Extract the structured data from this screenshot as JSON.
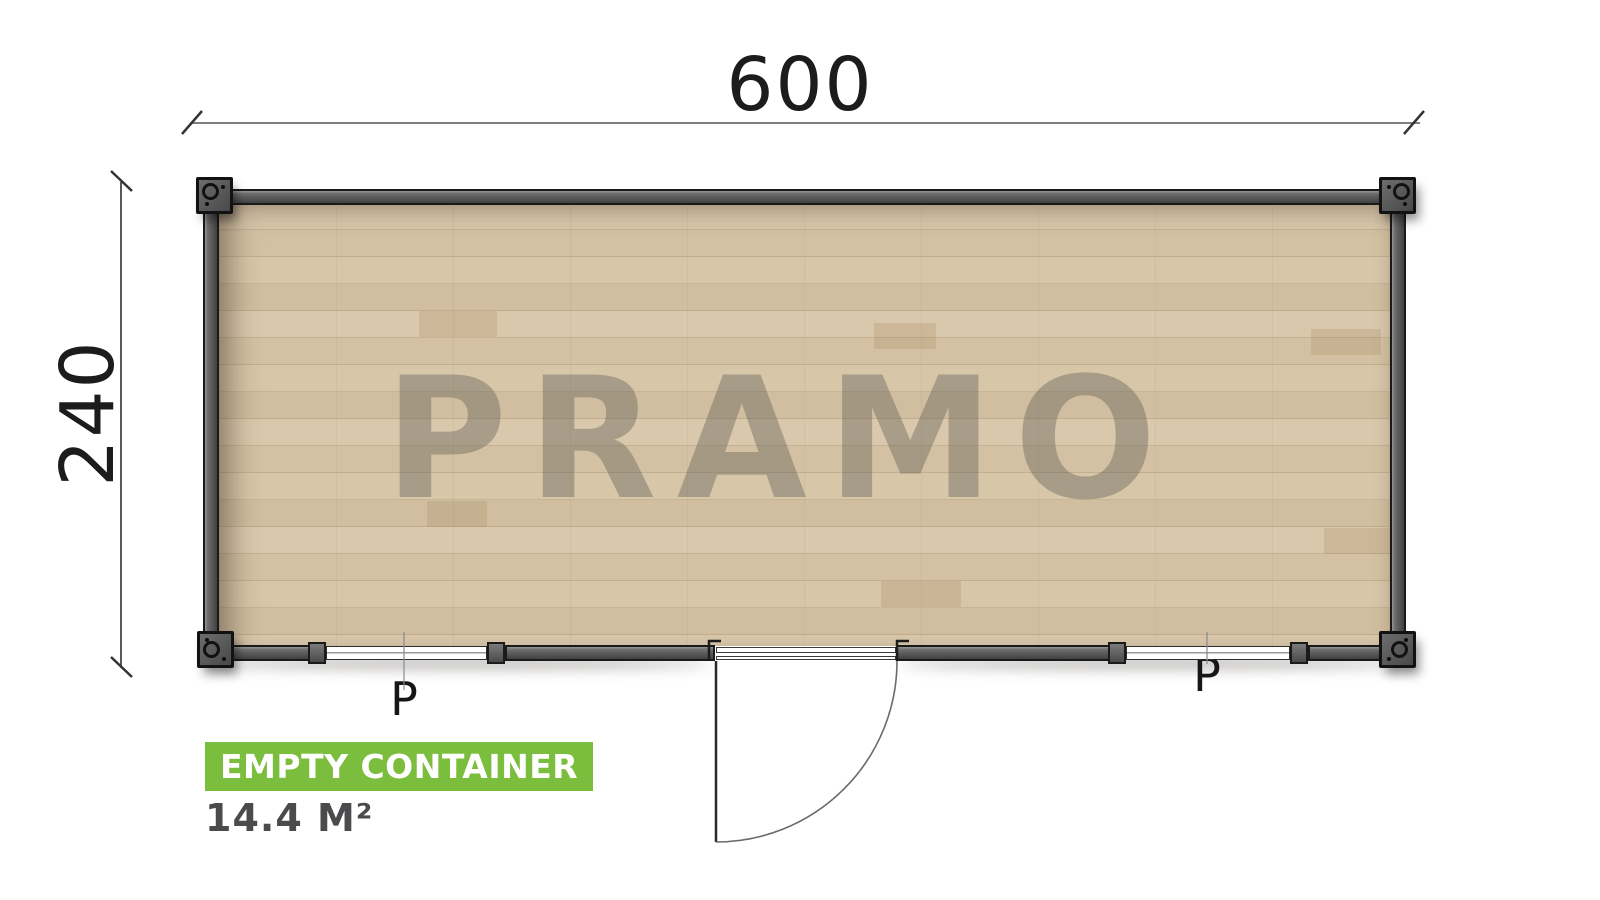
{
  "floorplan": {
    "watermark": "PRAMO",
    "width_dim": "600",
    "height_dim": "240",
    "window_labels": [
      "P",
      "P"
    ],
    "badge": {
      "title": "EMPTY CONTAINER",
      "area": "14.4 M²"
    },
    "colors": {
      "badge_green": "#7bbd3d",
      "wall_gray": "#5a5a5a",
      "floor_wood": "#d5c3a6",
      "area_text": "#4b4b4e"
    }
  }
}
